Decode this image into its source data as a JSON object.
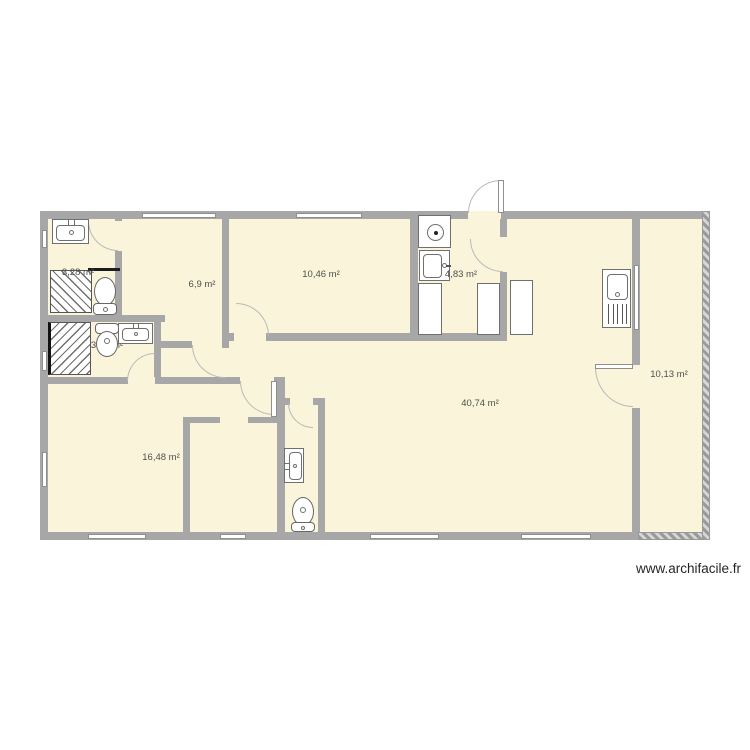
{
  "plan": {
    "source_watermark": "www.archifacile.fr",
    "rooms": [
      {
        "id": "bathroom-1",
        "area": "3,28 m²"
      },
      {
        "id": "bedroom-1",
        "area": "6,9 m²"
      },
      {
        "id": "living-room",
        "area": "10,46 m²"
      },
      {
        "id": "kitchen",
        "area": "4,83 m²"
      },
      {
        "id": "bathroom-2",
        "area": "3,06 m²"
      },
      {
        "id": "main-room",
        "area": "40,74 m²"
      },
      {
        "id": "bedroom-2",
        "area": "16,48 m²"
      },
      {
        "id": "annex-room",
        "area": "10,13 m²"
      }
    ],
    "fixtures": [
      "washbasin",
      "toilet",
      "shower",
      "hob",
      "kitchen-sink",
      "counter-unit",
      "sink-drainer-unit"
    ],
    "colors": {
      "floor": "#faf5da",
      "wall": "#a7a7a7",
      "hatched_wall": "#9a9a9a",
      "door_arc": "#b9b9b9",
      "fixture_outline": "#6f6f6f",
      "label_text": "#4f4f4f"
    }
  }
}
